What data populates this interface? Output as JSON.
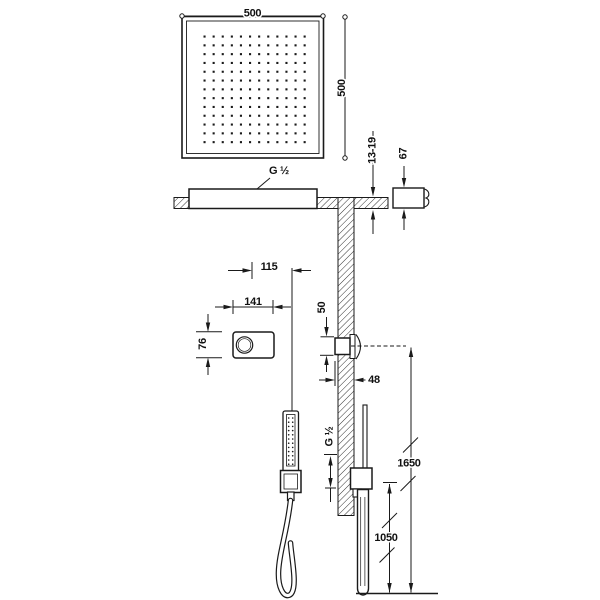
{
  "drawing": {
    "title": "Shower system technical drawing",
    "dims": {
      "head_width": "500",
      "head_height": "500",
      "head_connection": "G ½",
      "ceiling_thickness": "13-19",
      "arm_flange_height": "67",
      "panel_center_offset": "115",
      "panel_width": "141",
      "panel_height": "76",
      "valve_body_height": "50",
      "valve_projection": "48",
      "outlet_connection": "G ½",
      "valve_height_from_floor": "1650",
      "support_height_from_floor": "1050"
    }
  }
}
